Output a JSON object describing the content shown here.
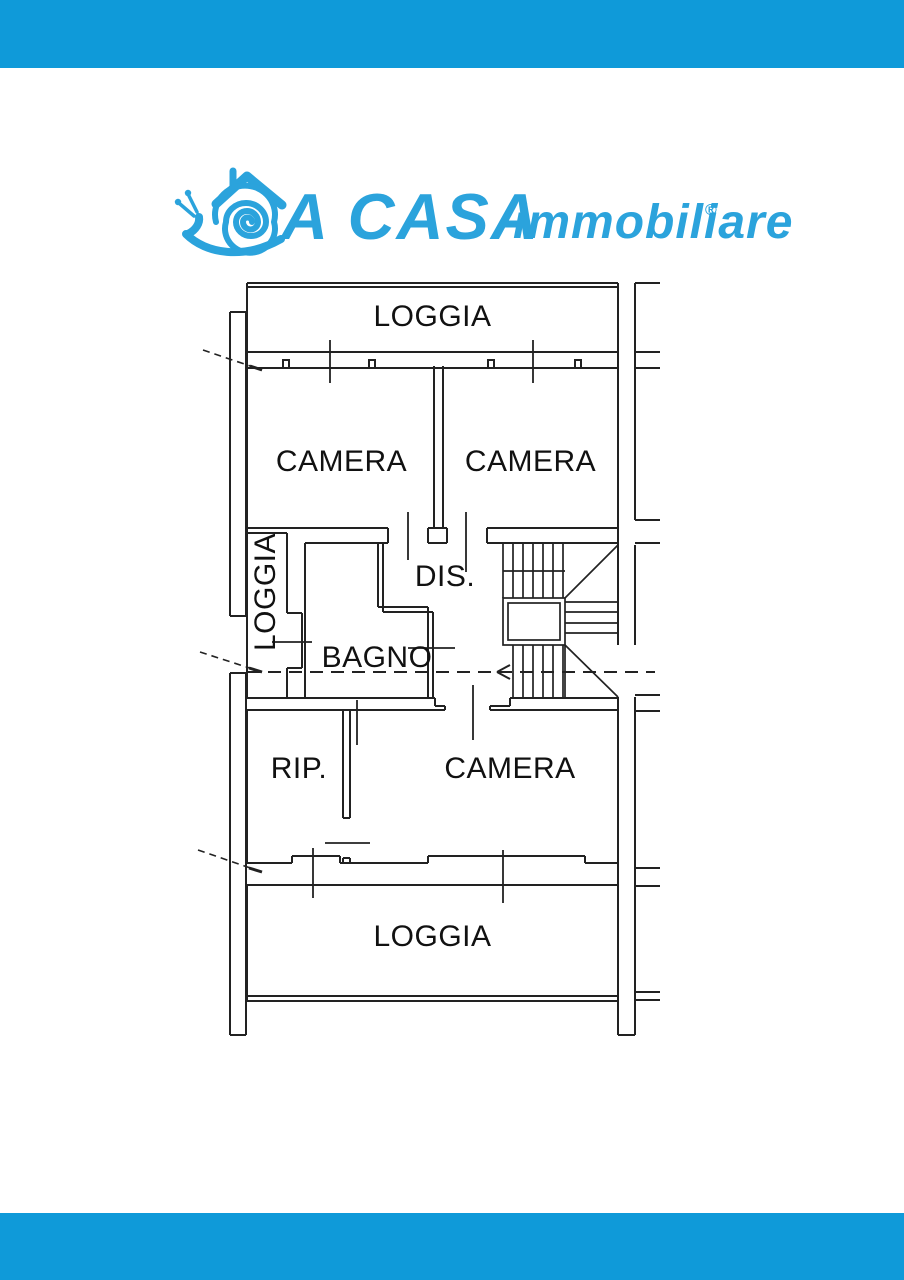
{
  "colors": {
    "bar": "#0f9ad9",
    "logo": "#2ba3dc",
    "line": "#222222",
    "page": "#ffffff"
  },
  "logo": {
    "brand": "A CASA",
    "subtitle": "immobiliare",
    "registered": "®",
    "icon": "snail-house"
  },
  "floorplan": {
    "rooms": [
      {
        "id": "loggia-top",
        "label": "LOGGIA"
      },
      {
        "id": "camera-left",
        "label": "CAMERA"
      },
      {
        "id": "camera-right",
        "label": "CAMERA"
      },
      {
        "id": "loggia-side",
        "label": "LOGGIA"
      },
      {
        "id": "dis",
        "label": "DIS."
      },
      {
        "id": "bagno",
        "label": "BAGNO"
      },
      {
        "id": "rip",
        "label": "RIP."
      },
      {
        "id": "camera-bottom",
        "label": "CAMERA"
      },
      {
        "id": "loggia-bottom",
        "label": "LOGGIA"
      }
    ]
  }
}
